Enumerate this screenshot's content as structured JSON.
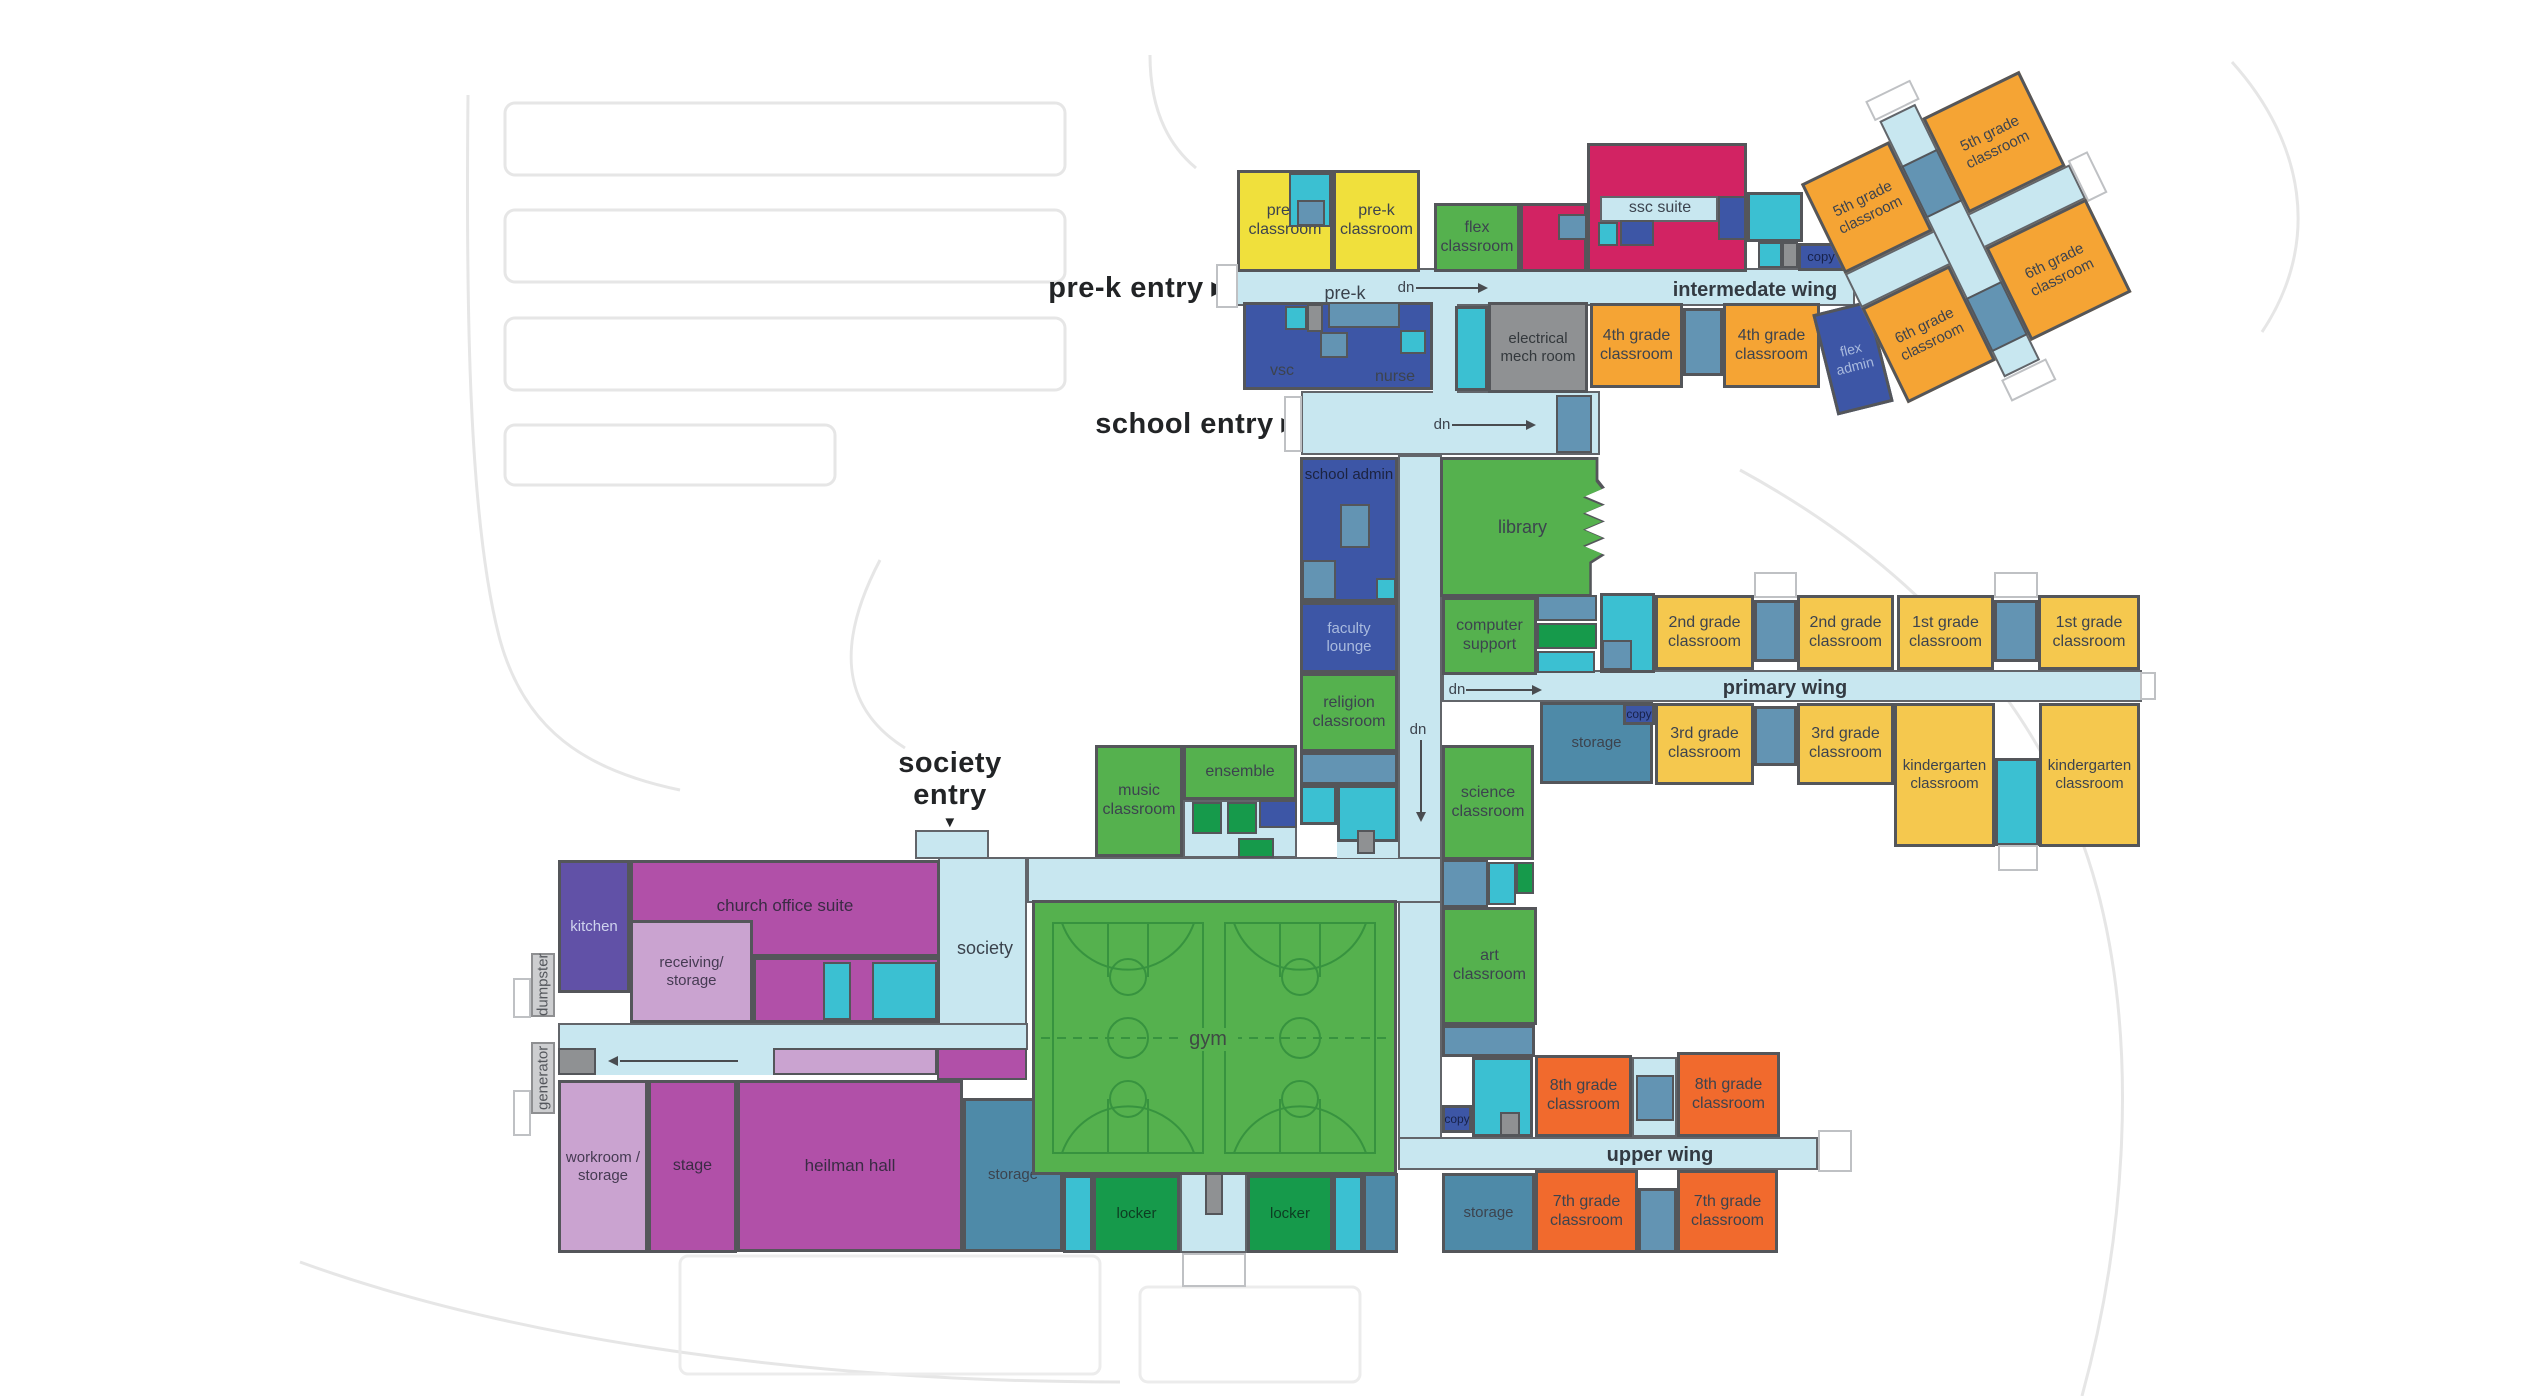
{
  "entries": {
    "prek": "pre-k entry",
    "school": "school entry",
    "society_line1": "society",
    "society_line2": "entry"
  },
  "icons": {
    "arrow_right": "▶",
    "arrow_down": "▼"
  },
  "corridors": {
    "prek": "pre-k",
    "dn": "dn",
    "intermediate": "intermedate wing",
    "primary": "primary wing",
    "upper": "upper wing",
    "society": "society"
  },
  "rooms": {
    "prek_classroom": "pre-k classroom",
    "flex_classroom": "flex classroom",
    "ssc_suite": "ssc suite",
    "copy": "copy",
    "grade5": "5th grade classroom",
    "grade6": "6th grade classroom",
    "grade4": "4th grade classroom",
    "flex_admin": "flex admin",
    "electrical": "electrical mech room",
    "vsc": "vsc",
    "nurse": "nurse",
    "school_admin": "school admin",
    "library": "library",
    "computer_support": "computer support",
    "faculty_lounge": "faculty lounge",
    "religion": "religion classroom",
    "grade2": "2nd grade classroom",
    "grade1": "1st grade classroom",
    "grade3": "3rd grade classroom",
    "kindergarten": "kindergarten classroom",
    "storage": "storage",
    "music": "music classroom",
    "ensemble": "ensemble",
    "science": "science classroom",
    "art": "art classroom",
    "gym": "gym",
    "kitchen": "kitchen",
    "church_office": "church office suite",
    "receiving": "receiving/ storage",
    "workroom": "workroom / storage",
    "stage": "stage",
    "heilman": "heilman hall",
    "locker": "locker",
    "grade7": "7th grade classroom",
    "grade8": "8th grade classroom",
    "dumpster": "dumpster",
    "generator": "generator"
  }
}
